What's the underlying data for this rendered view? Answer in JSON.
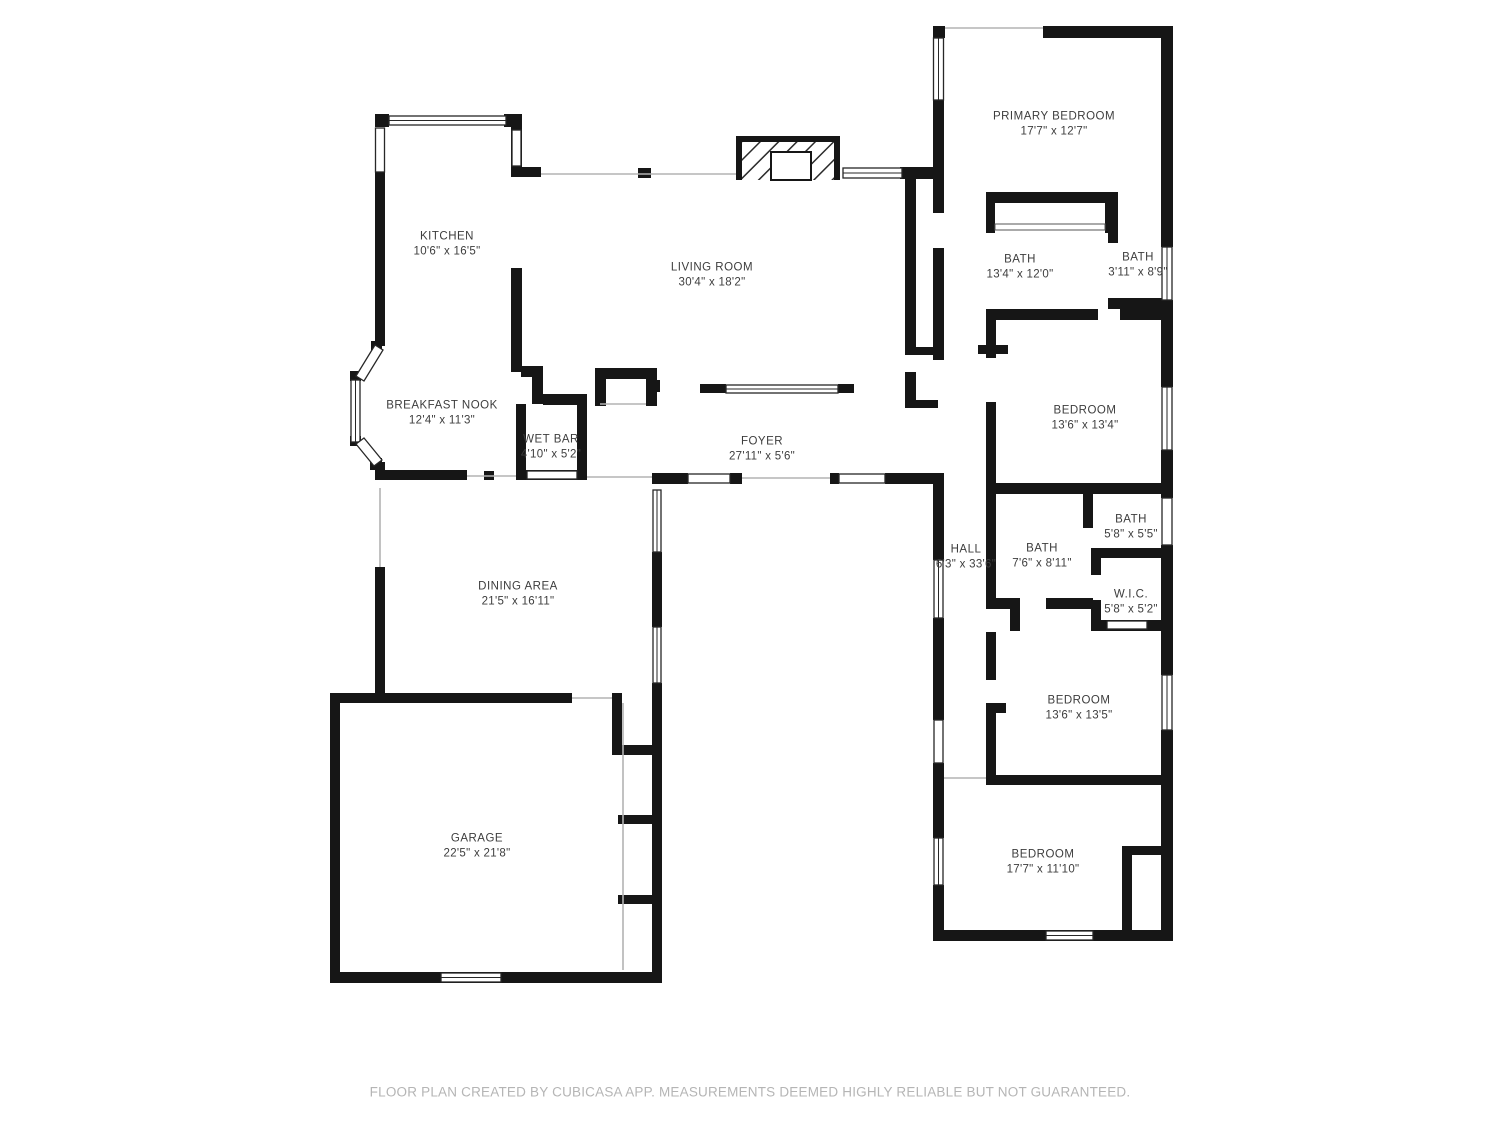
{
  "colors": {
    "wall": "#161616",
    "label_text": "#3d3d3d",
    "footer_text": "#b5b5b5",
    "thin_line": "#b3b3b3",
    "background": "#ffffff"
  },
  "rooms": [
    {
      "id": "kitchen",
      "name": "KITCHEN",
      "dims": "10'6\" x 16'5\""
    },
    {
      "id": "living-room",
      "name": "LIVING ROOM",
      "dims": "30'4\" x 18'2\""
    },
    {
      "id": "primary-bedroom",
      "name": "PRIMARY BEDROOM",
      "dims": "17'7\" x 12'7\""
    },
    {
      "id": "bath-primary",
      "name": "BATH",
      "dims": "13'4\" x 12'0\""
    },
    {
      "id": "bath-primary-2",
      "name": "BATH",
      "dims": "3'11\" x 8'9\""
    },
    {
      "id": "breakfast-nook",
      "name": "BREAKFAST NOOK",
      "dims": "12'4\" x 11'3\""
    },
    {
      "id": "wet-bar",
      "name": "WET BAR",
      "dims": "4'10\" x 5'2\""
    },
    {
      "id": "foyer",
      "name": "FOYER",
      "dims": "27'11\" x 5'6\""
    },
    {
      "id": "bedroom-ne",
      "name": "BEDROOM",
      "dims": "13'6\" x 13'4\""
    },
    {
      "id": "hall",
      "name": "HALL",
      "dims": "6'3\" x 33'6\""
    },
    {
      "id": "bath-hall",
      "name": "BATH",
      "dims": "7'6\" x 8'11\""
    },
    {
      "id": "bath-small",
      "name": "BATH",
      "dims": "5'8\" x 5'5\""
    },
    {
      "id": "wic",
      "name": "W.I.C.",
      "dims": "5'8\" x 5'2\""
    },
    {
      "id": "dining-area",
      "name": "DINING AREA",
      "dims": "21'5\" x 16'11\""
    },
    {
      "id": "bedroom-e",
      "name": "BEDROOM",
      "dims": "13'6\" x 13'5\""
    },
    {
      "id": "garage",
      "name": "GARAGE",
      "dims": "22'5\" x 21'8\""
    },
    {
      "id": "bedroom-se",
      "name": "BEDROOM",
      "dims": "17'7\" x 11'10\""
    }
  ],
  "footer": {
    "text": "FLOOR PLAN CREATED BY CUBICASA APP. MEASUREMENTS DEEMED HIGHLY RELIABLE BUT NOT GUARANTEED."
  }
}
